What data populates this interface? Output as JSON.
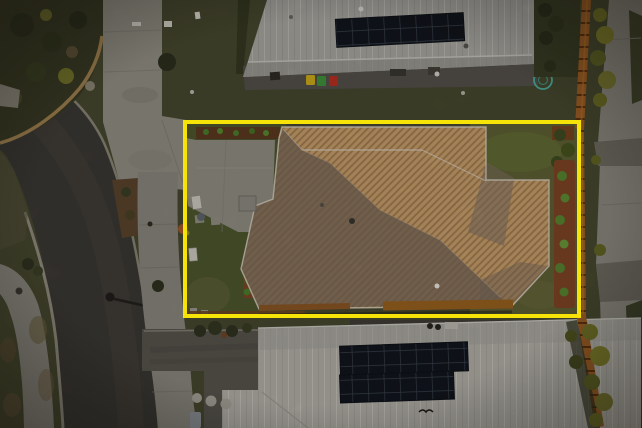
{
  "scene": {
    "type": "aerial-drone-photograph",
    "subject": "Single-storey house with corrugated hip metal roof outlined by a yellow property boundary",
    "setting": "Suburban street at dusk; neighbouring homes above and below, timber paling fence and public footpath on the right, curved road on the left",
    "canvas": {
      "width": 642,
      "height": 428
    }
  },
  "boundary": {
    "x": 185,
    "y": 122,
    "width": 394,
    "height": 194,
    "color": "#f6e409",
    "thickness": 4
  },
  "subject_property": {
    "roof_lit": "#c49c68",
    "roof_stripe": "#9f7a50",
    "roof_shaded": "#6f6156",
    "roof_shaded_light": "#7e6f62",
    "ridge_cap": "#d9d0c2",
    "fascia_timber": "#8a5524",
    "pad_concrete": "#93908a",
    "front_lawn": "#4d552d",
    "back_lawn": "#5d5e33",
    "garden_bed": "#7c4424",
    "mulch": "#5c3a20"
  },
  "neighbours": {
    "top_house_roof": "#a6a49d",
    "top_house_patio": "#53504a",
    "bottom_house_roof": "#aeaca4",
    "solar_panel": "#11161d",
    "solar_grid_line": "#3a414c",
    "bins": [
      {
        "name": "yellow-bin",
        "color": "#c9a81b"
      },
      {
        "name": "green-bin",
        "color": "#3f8f3b"
      },
      {
        "name": "red-bin",
        "color": "#b52f20"
      }
    ],
    "garden_hose": "#4db3a6"
  },
  "street": {
    "road": "#3b3833",
    "road_wear": "#49443b",
    "kerb": "#948f80",
    "footpath": "#87847a",
    "concrete_apron": "#8e8b81",
    "driveway_crossing": "#6b675f",
    "bottom_driveway": "#56534b"
  },
  "fence": {
    "color": "#9a5d26",
    "joint": "#5a320f",
    "lit": "#b06c2a"
  },
  "vegetation": {
    "grass_base": "#46472e",
    "grass_top_lawn": "#45472e",
    "grass_dark": "#3a3d26",
    "shrub_dark": "#2f3220",
    "shrub_bright": "#55832f",
    "shrub_olive": "#74742c",
    "dirt": "#5f5239",
    "dry_grass": "#6b5f40"
  },
  "small_objects": {
    "air_conditioner": "#8b8880",
    "bench_white": "#c9c6bc",
    "stepping_stone": "#8f8c82",
    "round_paver": "#a3a096",
    "manhole": "#34322c",
    "letterbox": "#d8d5cc"
  }
}
